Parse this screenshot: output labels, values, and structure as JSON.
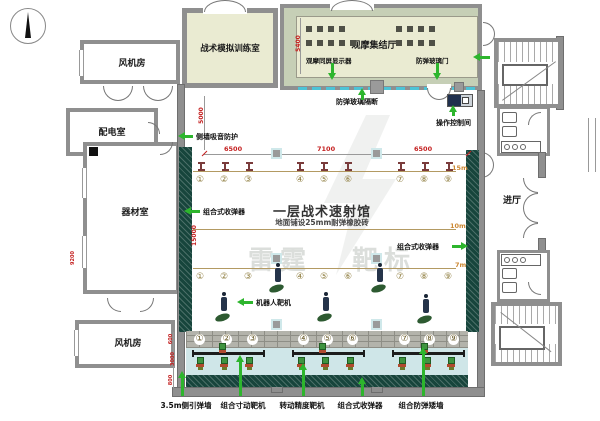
{
  "rooms": {
    "fan_room_top": "风机房",
    "power_distribution_room": "配电室",
    "equipment_room": "器材室",
    "fan_room_bottom": "风机房",
    "tactical_simulation_room": "战术模拟训练室",
    "observation_hall": "观摩集结厅",
    "entrance_hall": "进厅"
  },
  "hall": {
    "title": "一层战术速射馆",
    "subtitle": "地面铺设25mm耐弹橡胶砖",
    "watermark_left": "雷霆",
    "watermark_right": "靶标"
  },
  "annotations": {
    "side_wall_sound_absorption": "侧墙吸音防护",
    "observation_screen_display": "观摩同屏显示器",
    "bulletproof_glass_door": "防弹玻璃门",
    "bulletproof_glass_partition": "防弹玻璃隔断",
    "operation_control_room": "操作控制间",
    "collector_left": "组合式收弹器",
    "collector_right": "组合式收弹器",
    "robot_target": "机器人靶机",
    "bottom_labels": [
      "3.5m侧引弹墙",
      "组合寸动靶机",
      "转动精度靶机",
      "组合式收弹器",
      "组合防弹矮墙"
    ]
  },
  "dimensions": {
    "top_spans": [
      "6500",
      "7100",
      "6500"
    ],
    "observation_hall_depth": "5400",
    "hall_upper_left": "5000",
    "hall_length_left": "15000",
    "left_wing_vertical": "9200",
    "bottom_left_small": [
      "600",
      "3000",
      "800"
    ]
  },
  "range_markers": {
    "m15": "15m",
    "m10": "10m",
    "m7": "7m"
  },
  "lanes": [
    "①",
    "②",
    "③",
    "④",
    "⑤",
    "⑥",
    "⑦",
    "⑧",
    "⑨"
  ],
  "colors": {
    "arrow_green": "#2db52d",
    "dimension_red": "#c41f1f",
    "bullet_trap_green": "#17453c",
    "glass_cyan": "#4cc3d6",
    "room_fill": "#eaebd2",
    "observation_fill": "#c6cfb6",
    "range_line_tan": "#b39a62",
    "distance_orange": "#cc8833"
  }
}
